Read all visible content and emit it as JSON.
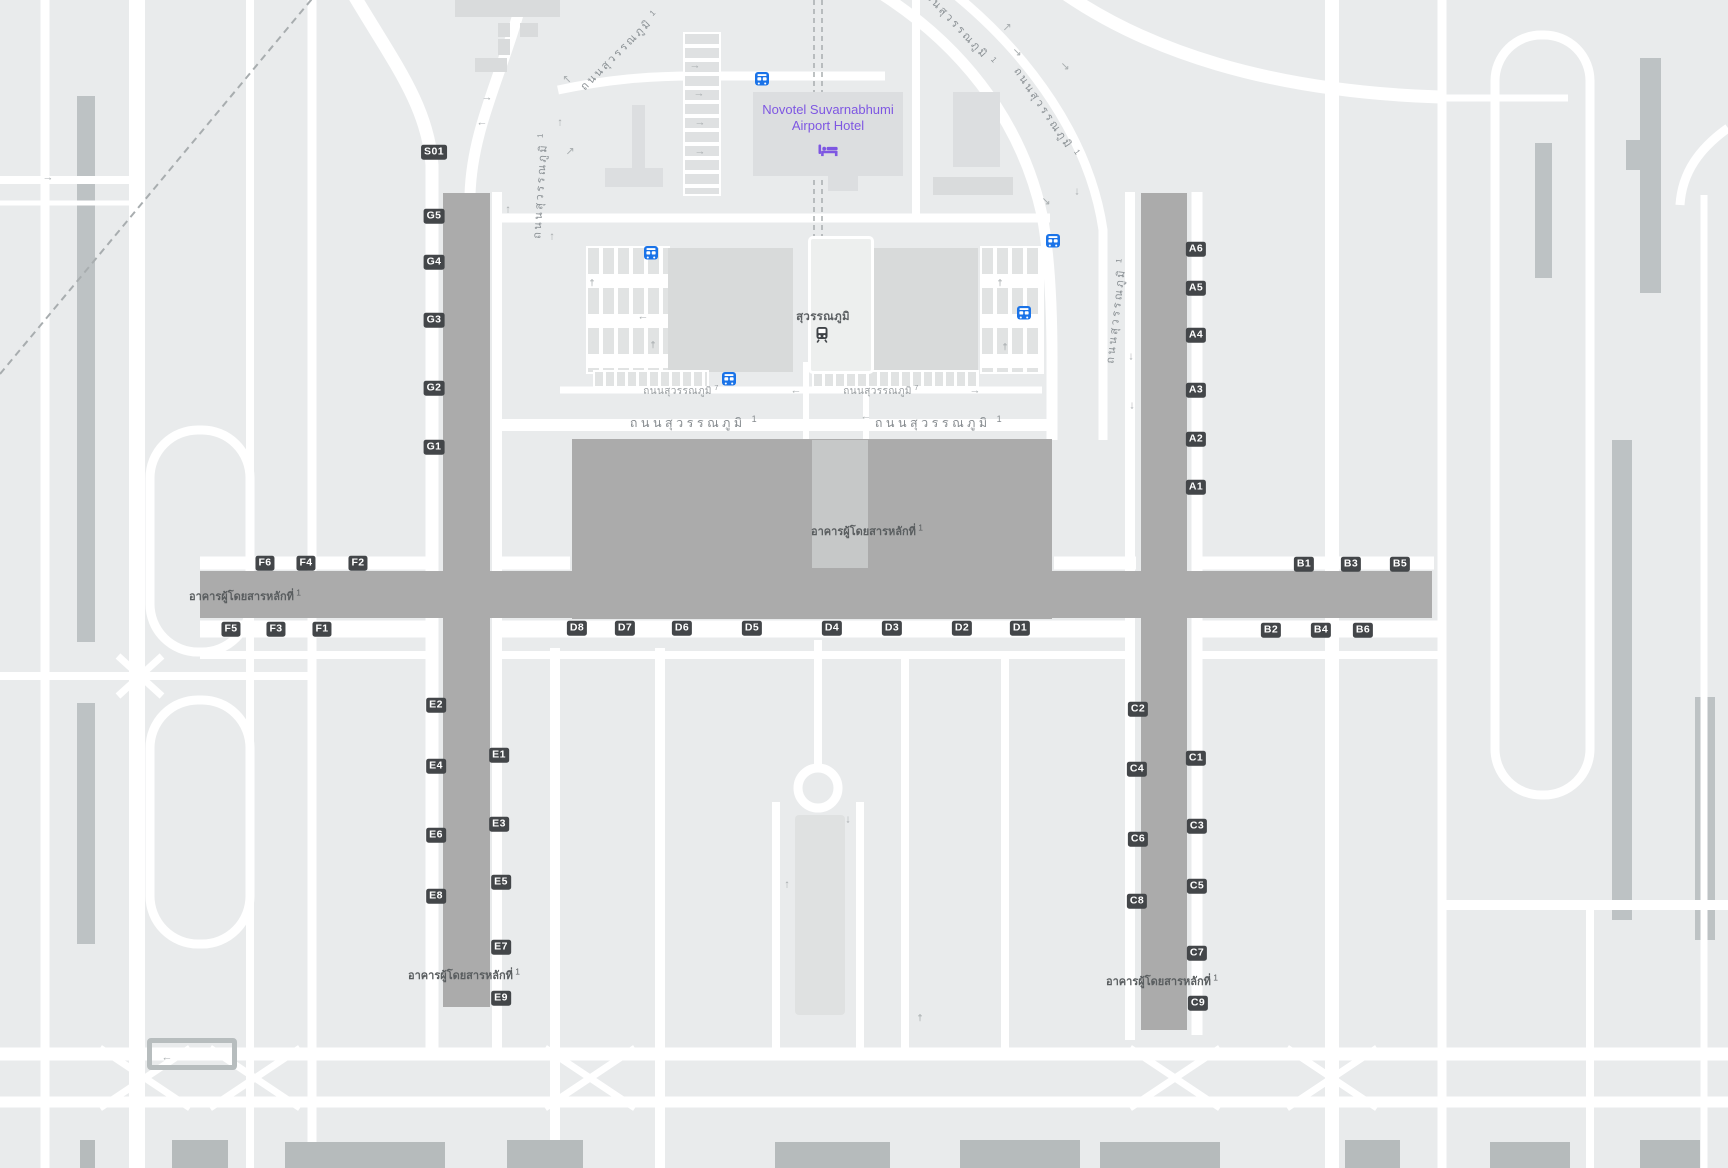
{
  "map": {
    "colors": {
      "background": "#e9ebec",
      "road": "#ffffff",
      "terminal": "#ababab",
      "building_light": "#dcdee0",
      "garage": "#d8dada",
      "runway_strip": "#bdc2c4",
      "badge_bg": "#434649",
      "badge_text": "#ffffff",
      "terminal_text": "#595d5f",
      "road_label": "#8a9094",
      "hotel_purple": "#7e57e2",
      "bus_blue": "#1a73e8",
      "train_dark": "#3f4347",
      "bottom_building": "#b6bbbc"
    },
    "hotel": {
      "name_line1": "Novotel Suvarnabhumi",
      "name_line2": "Airport Hotel",
      "icon": "bed-icon"
    },
    "station": {
      "name": "สุวรรณภูมิ",
      "icon": "train-icon"
    },
    "terminal_label_text": "อาคารผู้โดยสารหลักที่",
    "terminal_label_sup": "1",
    "terminal_labels": [
      {
        "x": 867,
        "y": 531
      },
      {
        "x": 245,
        "y": 596
      },
      {
        "x": 464,
        "y": 975
      },
      {
        "x": 1162,
        "y": 981
      }
    ],
    "road_labels": [
      {
        "text": "ถนนสุวรรณภูมิ",
        "sup": "1",
        "x": 695,
        "y": 423,
        "rot": 0,
        "cls": "rl-lg"
      },
      {
        "text": "ถนนสุวรรณภูมิ",
        "sup": "1",
        "x": 940,
        "y": 423,
        "rot": 0,
        "cls": "rl-lg"
      },
      {
        "text": "ถนนสุวรรณภูมิ",
        "sup": "7",
        "x": 681,
        "y": 391,
        "rot": 0,
        "cls": "rl-sm"
      },
      {
        "text": "ถนนสุวรรณภูมิ",
        "sup": "7",
        "x": 881,
        "y": 391,
        "rot": 0,
        "cls": "rl-sm"
      },
      {
        "text": "ถนนสุวรรณภูมิ",
        "sup": "1",
        "x": 620,
        "y": 50,
        "rot": -45,
        "cls": "rl-md"
      },
      {
        "text": "ถนนสุวรรณภูมิ",
        "sup": "1",
        "x": 540,
        "y": 185,
        "rot": -86,
        "cls": "rl-md"
      },
      {
        "text": "ถนนสุวรรณภูมิ",
        "sup": "1",
        "x": 958,
        "y": 26,
        "rot": 47,
        "cls": "rl-md"
      },
      {
        "text": "ถนนสุวรรณภูมิ",
        "sup": "1",
        "x": 1047,
        "y": 113,
        "rot": 56,
        "cls": "rl-md"
      },
      {
        "text": "ถนนสุวรรณภูมิ",
        "sup": "1",
        "x": 1116,
        "y": 310,
        "rot": -83,
        "cls": "rl-md"
      }
    ],
    "gates": [
      {
        "label": "S01",
        "x": 434,
        "y": 152
      },
      {
        "label": "G5",
        "x": 434,
        "y": 216
      },
      {
        "label": "G4",
        "x": 434,
        "y": 262
      },
      {
        "label": "G3",
        "x": 434,
        "y": 320
      },
      {
        "label": "G2",
        "x": 434,
        "y": 388
      },
      {
        "label": "G1",
        "x": 434,
        "y": 447
      },
      {
        "label": "A6",
        "x": 1196,
        "y": 249
      },
      {
        "label": "A5",
        "x": 1196,
        "y": 288
      },
      {
        "label": "A4",
        "x": 1196,
        "y": 335
      },
      {
        "label": "A3",
        "x": 1196,
        "y": 390
      },
      {
        "label": "A2",
        "x": 1196,
        "y": 439
      },
      {
        "label": "A1",
        "x": 1196,
        "y": 487
      },
      {
        "label": "F6",
        "x": 265,
        "y": 563
      },
      {
        "label": "F4",
        "x": 306,
        "y": 563
      },
      {
        "label": "F2",
        "x": 358,
        "y": 563
      },
      {
        "label": "F5",
        "x": 231,
        "y": 629
      },
      {
        "label": "F3",
        "x": 276,
        "y": 629
      },
      {
        "label": "F1",
        "x": 322,
        "y": 629
      },
      {
        "label": "D8",
        "x": 577,
        "y": 628
      },
      {
        "label": "D7",
        "x": 625,
        "y": 628
      },
      {
        "label": "D6",
        "x": 682,
        "y": 628
      },
      {
        "label": "D5",
        "x": 752,
        "y": 628
      },
      {
        "label": "D4",
        "x": 832,
        "y": 628
      },
      {
        "label": "D3",
        "x": 892,
        "y": 628
      },
      {
        "label": "D2",
        "x": 962,
        "y": 628
      },
      {
        "label": "D1",
        "x": 1020,
        "y": 628
      },
      {
        "label": "B1",
        "x": 1304,
        "y": 564
      },
      {
        "label": "B3",
        "x": 1351,
        "y": 564
      },
      {
        "label": "B5",
        "x": 1400,
        "y": 564
      },
      {
        "label": "B2",
        "x": 1271,
        "y": 630
      },
      {
        "label": "B4",
        "x": 1321,
        "y": 630
      },
      {
        "label": "B6",
        "x": 1363,
        "y": 630
      },
      {
        "label": "E2",
        "x": 436,
        "y": 705
      },
      {
        "label": "E4",
        "x": 436,
        "y": 766
      },
      {
        "label": "E6",
        "x": 436,
        "y": 835
      },
      {
        "label": "E8",
        "x": 436,
        "y": 896
      },
      {
        "label": "E1",
        "x": 499,
        "y": 755
      },
      {
        "label": "E3",
        "x": 499,
        "y": 824
      },
      {
        "label": "E5",
        "x": 501,
        "y": 882
      },
      {
        "label": "E7",
        "x": 501,
        "y": 947
      },
      {
        "label": "E9",
        "x": 501,
        "y": 998
      },
      {
        "label": "C2",
        "x": 1138,
        "y": 709
      },
      {
        "label": "C4",
        "x": 1137,
        "y": 769
      },
      {
        "label": "C6",
        "x": 1138,
        "y": 839
      },
      {
        "label": "C8",
        "x": 1137,
        "y": 901
      },
      {
        "label": "C1",
        "x": 1196,
        "y": 758
      },
      {
        "label": "C3",
        "x": 1197,
        "y": 826
      },
      {
        "label": "C5",
        "x": 1197,
        "y": 886
      },
      {
        "label": "C7",
        "x": 1197,
        "y": 953
      },
      {
        "label": "C9",
        "x": 1198,
        "y": 1003
      }
    ],
    "buses": [
      {
        "x": 762,
        "y": 82
      },
      {
        "x": 651,
        "y": 256
      },
      {
        "x": 1053,
        "y": 244
      },
      {
        "x": 1024,
        "y": 316
      },
      {
        "x": 729,
        "y": 382
      }
    ],
    "arrows": [
      {
        "x": 695,
        "y": 66,
        "g": "→"
      },
      {
        "x": 699,
        "y": 94,
        "g": "→"
      },
      {
        "x": 700,
        "y": 123,
        "g": "→"
      },
      {
        "x": 700,
        "y": 152,
        "g": "→"
      },
      {
        "x": 487,
        "y": 98,
        "g": "→"
      },
      {
        "x": 482,
        "y": 123,
        "g": "←"
      },
      {
        "x": 560,
        "y": 123,
        "g": "↑"
      },
      {
        "x": 570,
        "y": 152,
        "g": "↗"
      },
      {
        "x": 567,
        "y": 80,
        "g": "↖"
      },
      {
        "x": 508,
        "y": 210,
        "g": "↑"
      },
      {
        "x": 552,
        "y": 237,
        "g": "↑"
      },
      {
        "x": 1007,
        "y": 28,
        "g": "↗"
      },
      {
        "x": 1017,
        "y": 53,
        "g": "↘"
      },
      {
        "x": 1065,
        "y": 67,
        "g": "↘"
      },
      {
        "x": 1077,
        "y": 192,
        "g": "↓"
      },
      {
        "x": 1046,
        "y": 202,
        "g": "↘"
      },
      {
        "x": 1131,
        "y": 357,
        "g": "↓"
      },
      {
        "x": 1132,
        "y": 406,
        "g": "↓"
      },
      {
        "x": 643,
        "y": 317,
        "g": "←"
      },
      {
        "x": 796,
        "y": 391,
        "g": "←"
      },
      {
        "x": 975,
        "y": 391,
        "g": "→"
      },
      {
        "x": 866,
        "y": 417,
        "g": "←"
      },
      {
        "x": 787,
        "y": 885,
        "g": "↑"
      },
      {
        "x": 848,
        "y": 820,
        "g": "↓"
      },
      {
        "x": 167,
        "y": 1058,
        "g": "←"
      },
      {
        "x": 48,
        "y": 178,
        "g": "→"
      }
    ],
    "crosses": [
      {
        "x": 592,
        "y": 283
      },
      {
        "x": 653,
        "y": 345
      },
      {
        "x": 1000,
        "y": 283
      },
      {
        "x": 1005,
        "y": 347
      },
      {
        "x": 920,
        "y": 1018
      }
    ]
  }
}
